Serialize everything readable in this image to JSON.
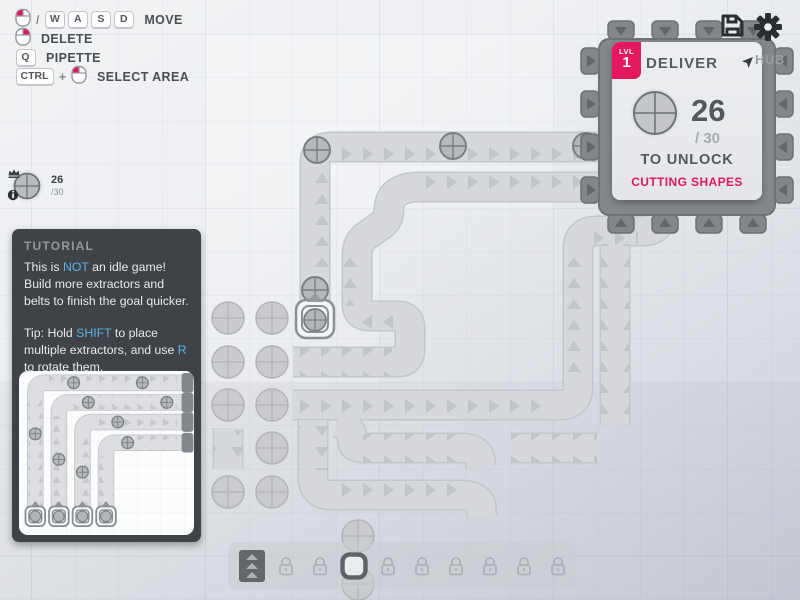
{
  "hints": {
    "slash": "/",
    "key_w": "W",
    "key_a": "A",
    "key_s": "S",
    "key_d": "D",
    "move_label": "MOVE",
    "delete_label": "DELETE",
    "key_q": "Q",
    "pipette_label": "PIPETTE",
    "key_ctrl": "CTRL",
    "plus": "+",
    "select_area_label": "SELECT AREA"
  },
  "goal_pin": {
    "amount": "26",
    "of_total": "/30"
  },
  "hub_panel": {
    "lvl_label": "LVL",
    "level": "1",
    "title": "DELIVER",
    "hub_label": "HUB",
    "amount": "26",
    "of_total": "/ 30",
    "unlock_text": "TO UNLOCK",
    "reward_text": "CUTTING SHAPES",
    "goal_shape": "circle"
  },
  "tutorial": {
    "title": "TUTORIAL",
    "p1_pre": "This is ",
    "p1_hl": "NOT",
    "p1_post": " an idle game! Build more extractors and belts to finish the goal quicker.",
    "p2_pre": "Tip: Hold ",
    "p2_hl1": "SHIFT",
    "p2_mid": " to place multiple extractors, and use ",
    "p2_hl2": "R",
    "p2_post": " to rotate them."
  },
  "toolbar": {
    "slots": [
      {
        "name": "belt",
        "locked": false
      },
      {
        "name": "locked",
        "locked": true
      },
      {
        "name": "locked",
        "locked": true
      },
      {
        "name": "extractor",
        "locked": false
      },
      {
        "name": "locked",
        "locked": true
      },
      {
        "name": "locked",
        "locked": true
      },
      {
        "name": "locked",
        "locked": true
      },
      {
        "name": "locked",
        "locked": true
      },
      {
        "name": "locked",
        "locked": true
      },
      {
        "name": "locked",
        "locked": true
      }
    ]
  },
  "world": {
    "resource_shape": "circle",
    "belt_item_shape": "circle"
  },
  "icons": [
    "mouse-left-icon",
    "mouse-right-icon",
    "save-icon",
    "settings-icon",
    "pin-icon",
    "crown-icon",
    "info-icon",
    "lock-icon",
    "belt-icon",
    "extractor-icon"
  ],
  "colors": {
    "accent_pink": "#e5175f",
    "link_blue": "#5fb0e5",
    "belt": "#d6d8db",
    "hub_body": "#84878c",
    "panel_dark": "#3f4347"
  }
}
